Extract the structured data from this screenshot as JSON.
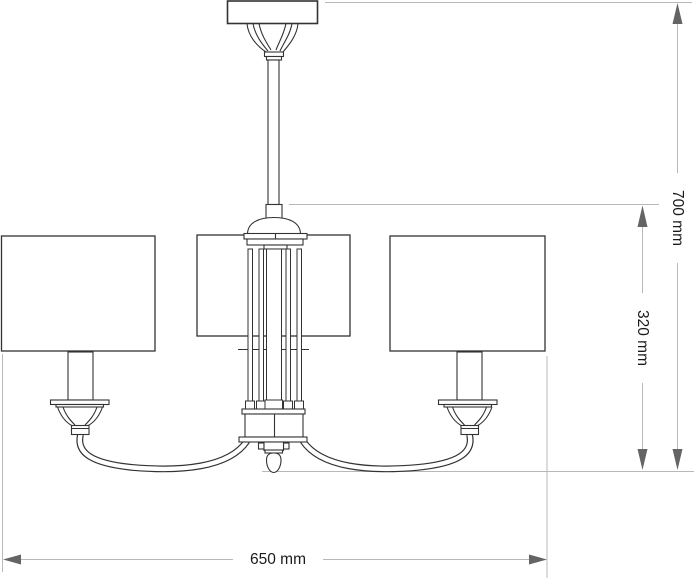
{
  "drawing": {
    "title": "chandelier-dimension-drawing",
    "dimensions": {
      "width": {
        "label": "650 mm",
        "value": 650,
        "unit": "mm"
      },
      "overall_height": {
        "label": "700 mm",
        "value": 700,
        "unit": "mm"
      },
      "body_height": {
        "label": "320 mm",
        "value": 320,
        "unit": "mm"
      }
    },
    "colors": {
      "background": "#ffffff",
      "outline": "#333333",
      "dimension_line": "#b8b8b8",
      "arrowhead": "#646464",
      "label_text": "#1a1a1a"
    }
  }
}
